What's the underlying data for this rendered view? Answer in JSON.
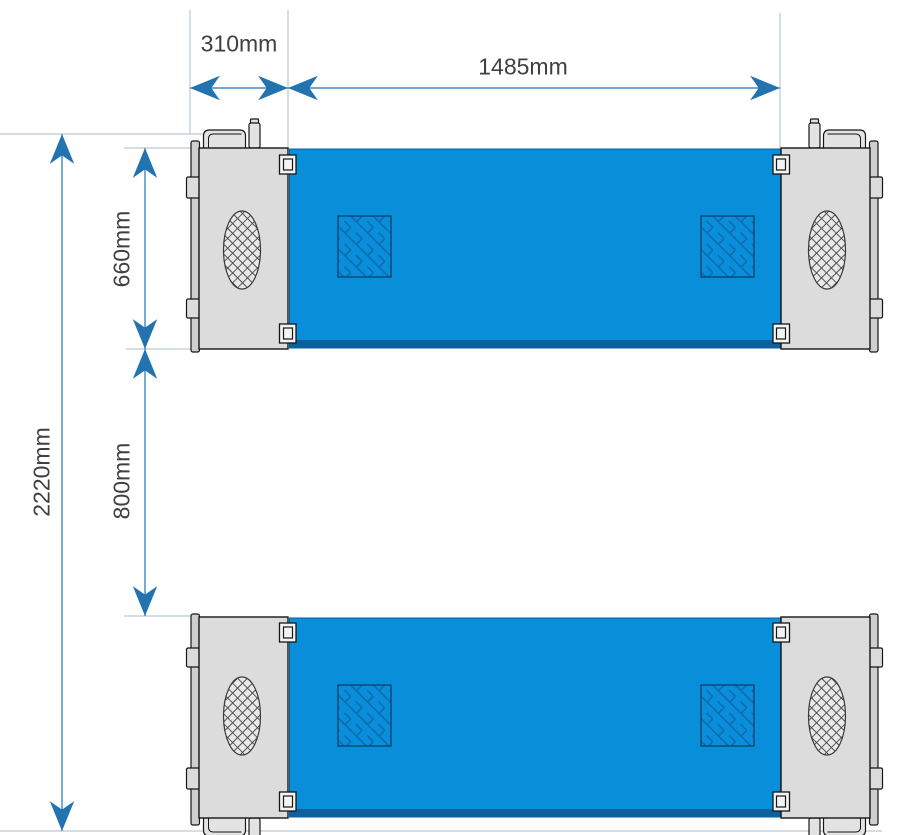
{
  "dimensions": {
    "dim_310": {
      "label": "310mm"
    },
    "dim_1485": {
      "label": "1485mm"
    },
    "dim_660": {
      "label": "660mm"
    },
    "dim_800": {
      "label": "800mm"
    },
    "dim_2220": {
      "label": "2220mm"
    }
  },
  "colors": {
    "background": "#ffffff",
    "deck_blue": "#098ed9",
    "deck_edge_blue": "#0d5f9e",
    "tread_hatch_blue": "#0f6bb0",
    "tread_outline": "#0a3a63",
    "plate_gray": "#dcdcdc",
    "rail_gray": "#cfcfcf",
    "handle_gray": "#e3e3e3",
    "outline_dark": "#161616",
    "vent_fill": "#e9e9e9",
    "vent_hatch": "#4a4a4a",
    "dimension_blue": "#2273b0",
    "extension_gray": "#aebecb",
    "label_text": "#3f4042"
  }
}
